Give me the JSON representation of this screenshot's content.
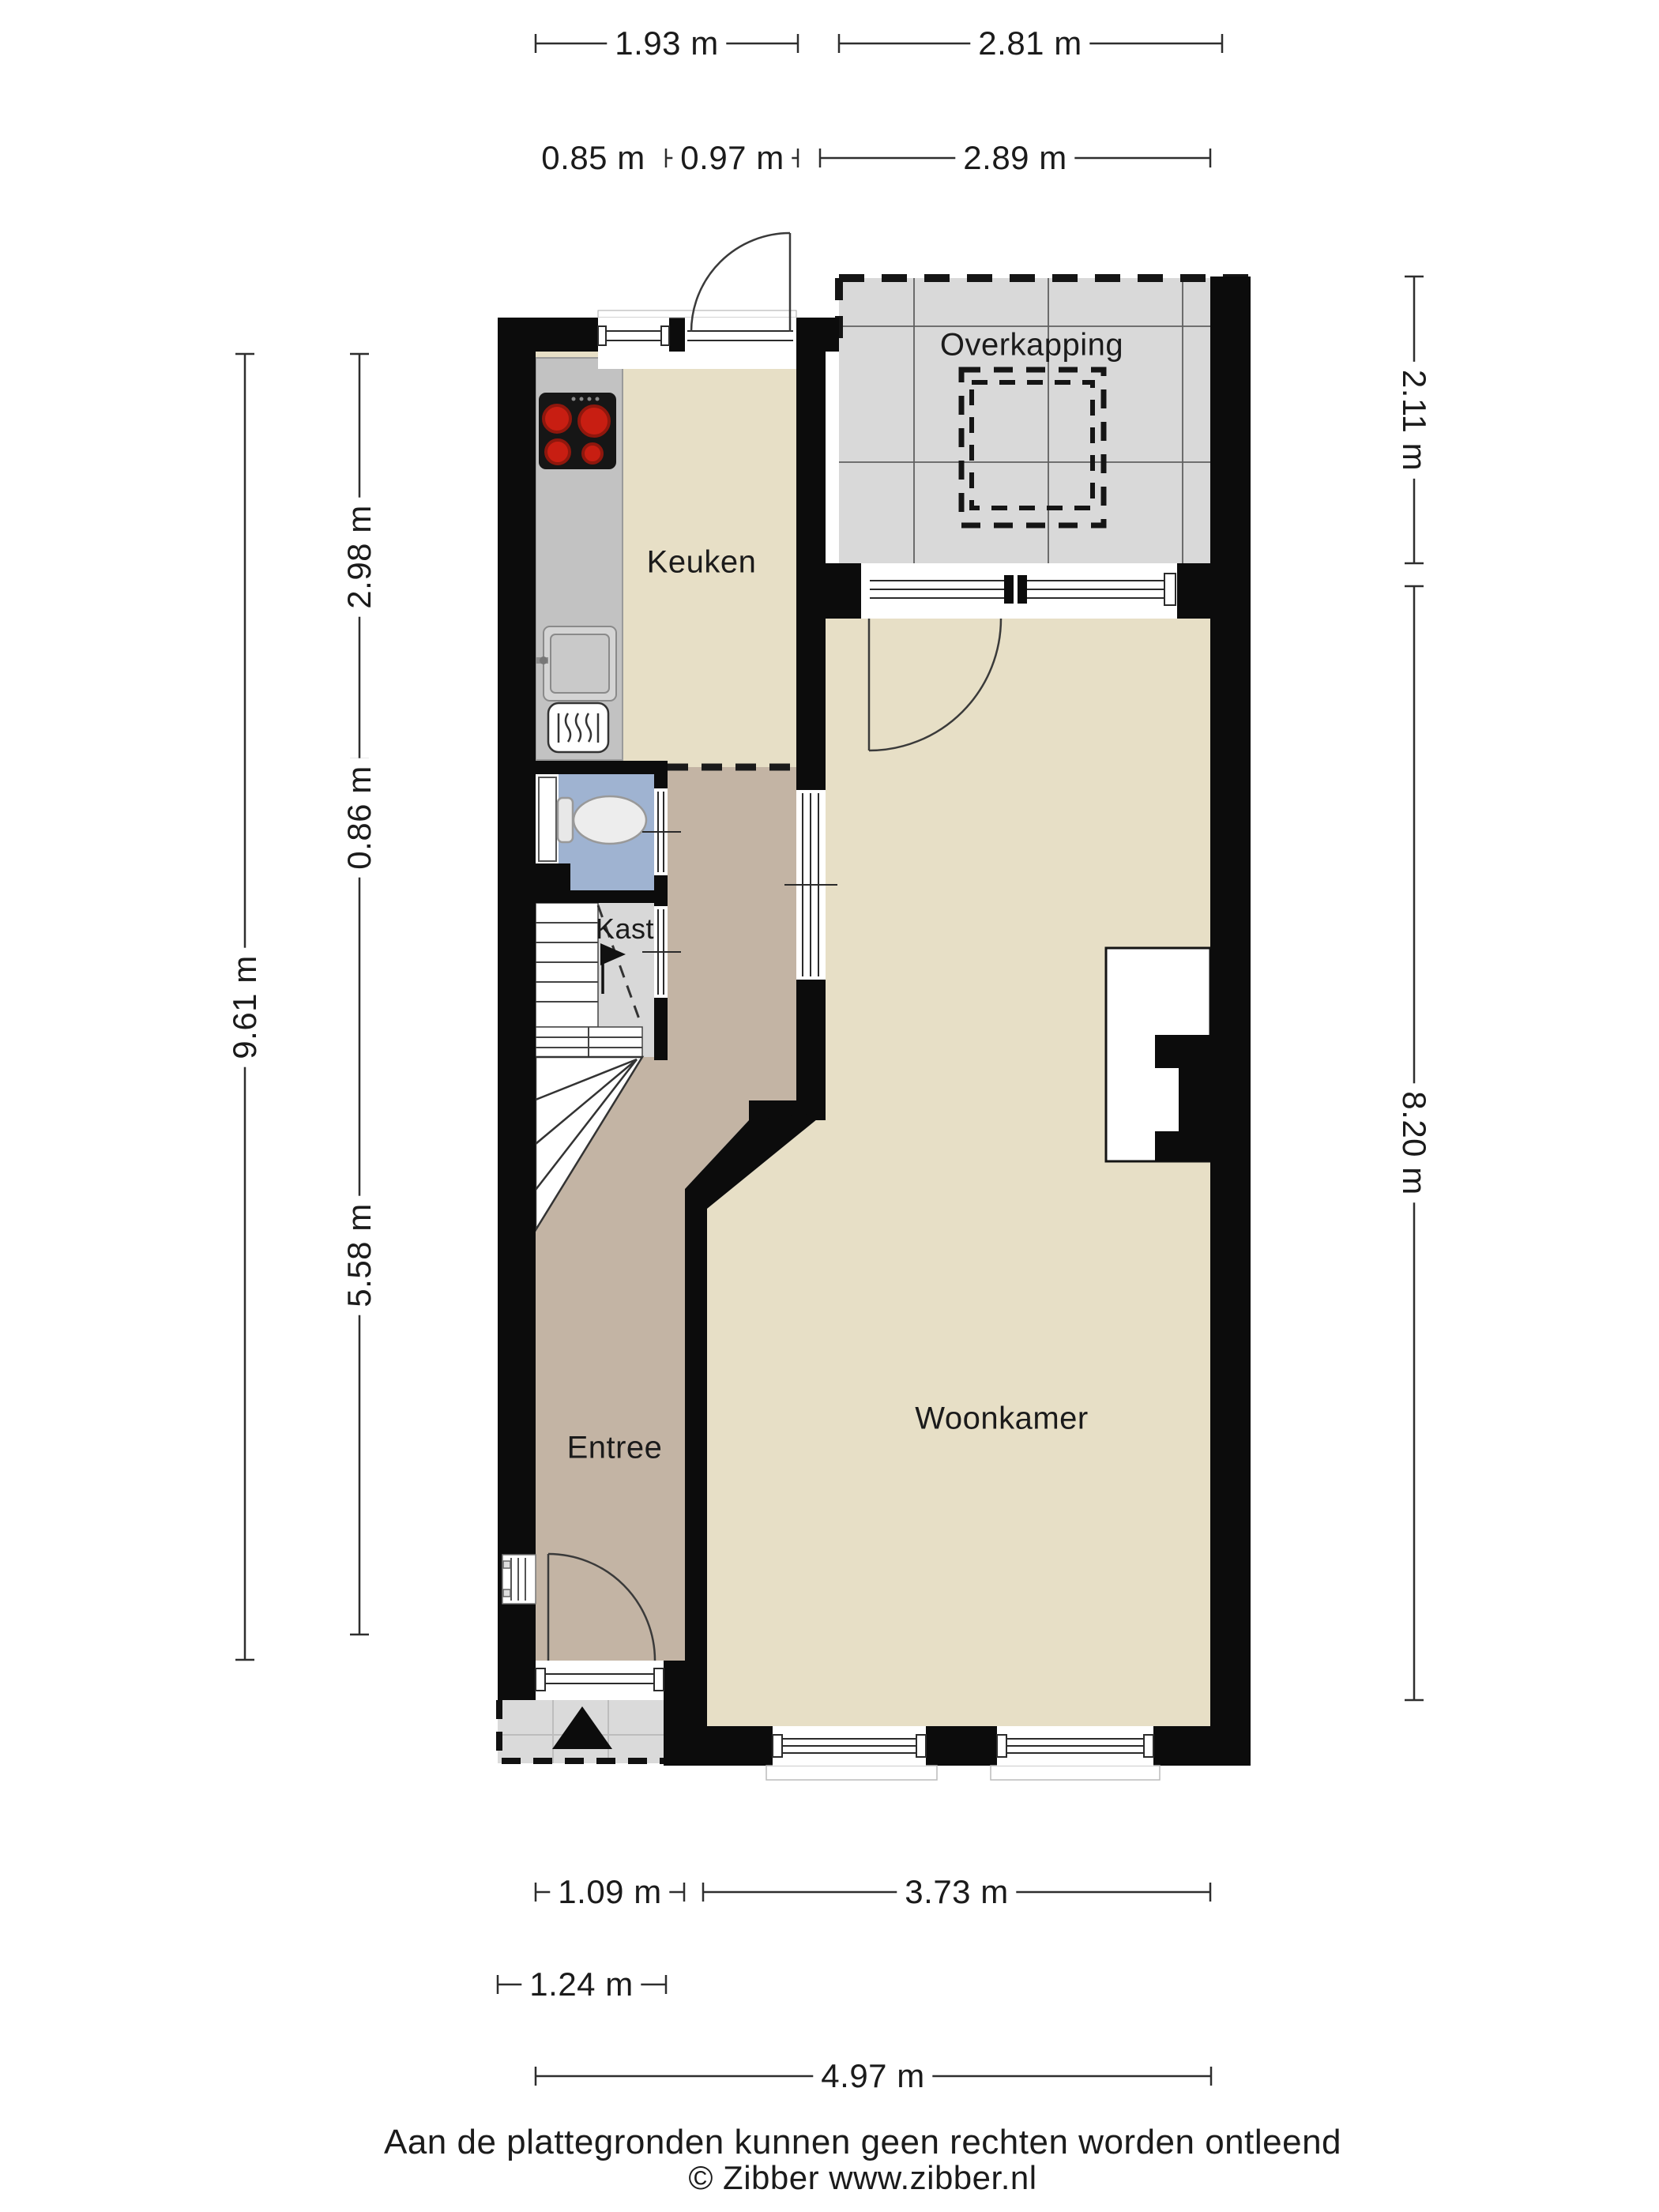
{
  "plan": {
    "type": "floorplan",
    "colors": {
      "wall": "#0c0c0c",
      "floor_main": "#e7dfc6",
      "floor_hall": "#c3b4a4",
      "floor_toilet": "#9fb3d1",
      "floor_closet": "#d8d8d8",
      "paving": "#d9d9d9",
      "counter": "#c2c2c2",
      "burner": "#c81e12"
    },
    "rooms": {
      "keuken": "Keuken",
      "overkapping": "Overkapping",
      "kast": "Kast",
      "entree": "Entree",
      "woonkamer": "Woonkamer"
    },
    "dimensions": {
      "top": [
        {
          "label": "1.93 m"
        },
        {
          "label": "2.81 m"
        },
        {
          "label": "0.85 m"
        },
        {
          "label": "0.97 m"
        },
        {
          "label": "2.89 m"
        }
      ],
      "left": [
        {
          "label": "9.61 m"
        },
        {
          "label": "2.98 m"
        },
        {
          "label": "0.86 m"
        },
        {
          "label": "5.58 m"
        }
      ],
      "right": [
        {
          "label": "2.11 m"
        },
        {
          "label": "8.20 m"
        }
      ],
      "bottom": [
        {
          "label": "1.09 m"
        },
        {
          "label": "3.73 m"
        },
        {
          "label": "1.24 m"
        },
        {
          "label": "4.97 m"
        }
      ]
    },
    "footer": {
      "disclaimer": "Aan de plattegronden kunnen geen rechten worden ontleend",
      "copyright": "© Zibber www.zibber.nl"
    }
  }
}
